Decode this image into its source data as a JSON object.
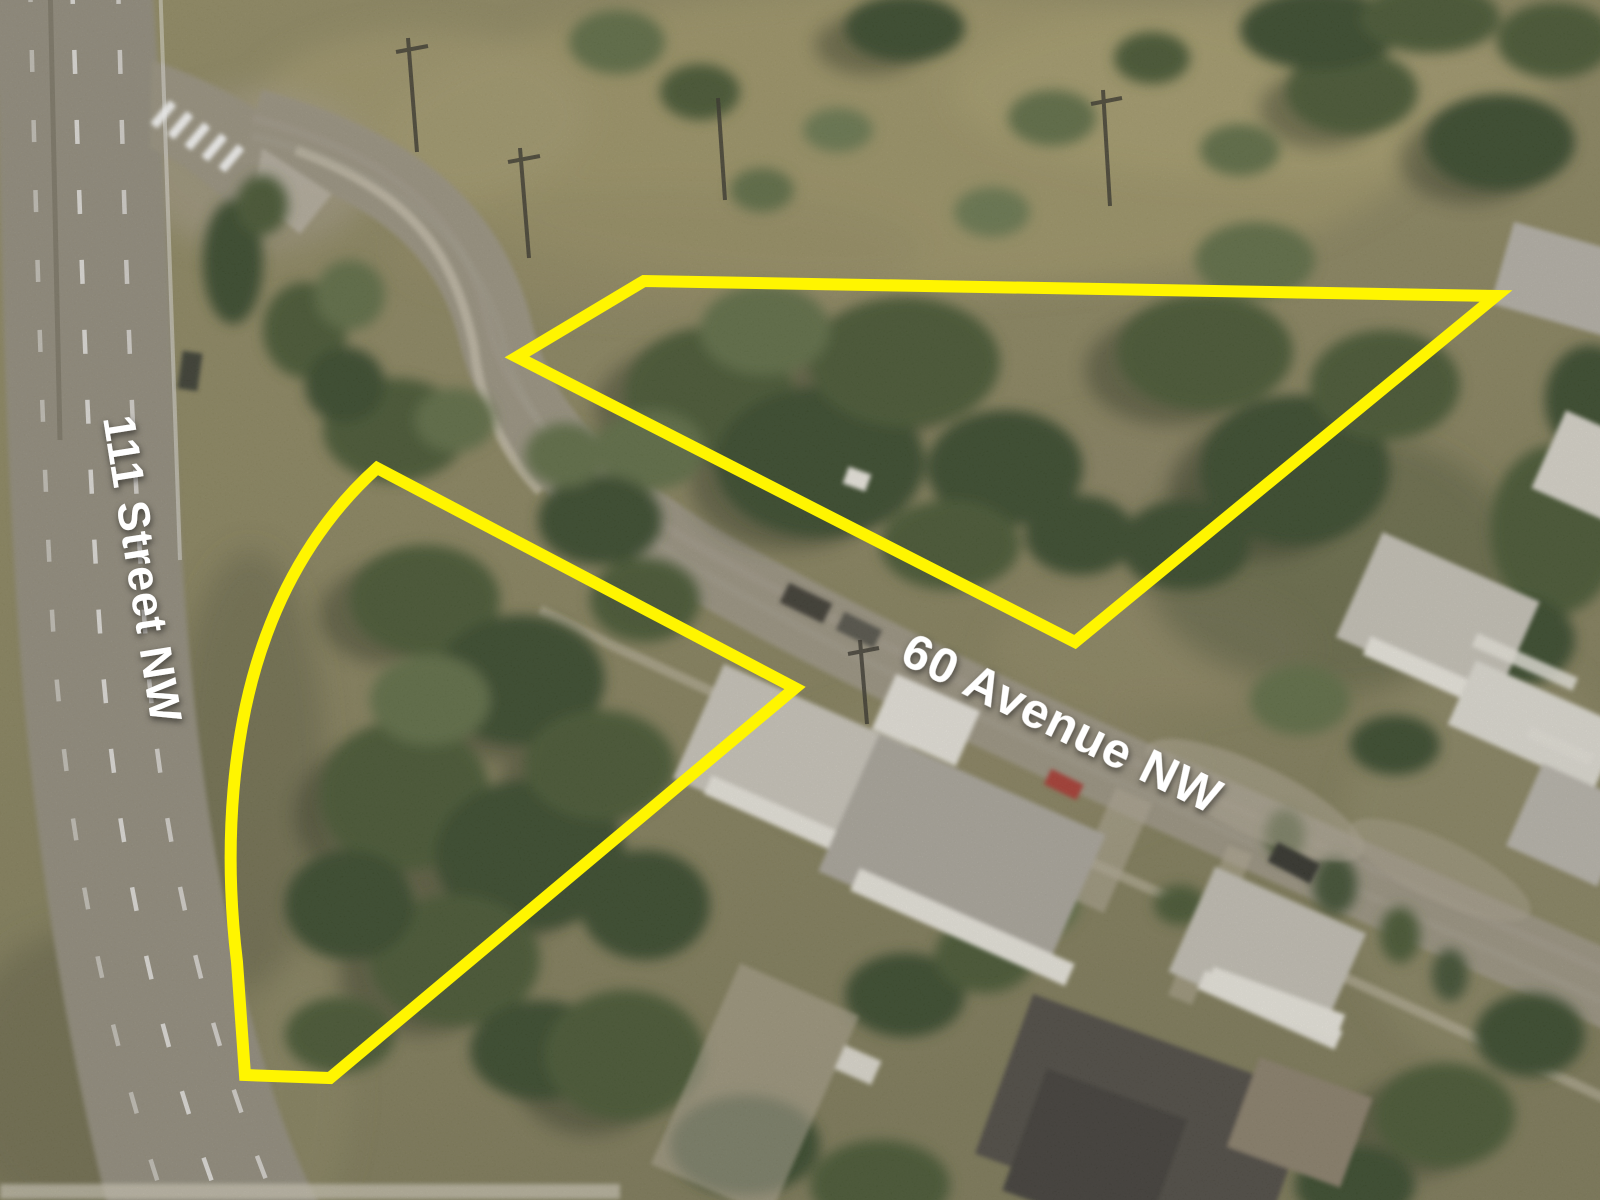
{
  "labels": {
    "street_vertical": {
      "text": "111 Street NW",
      "color": "#ffffff"
    },
    "street_diagonal": {
      "text": "60 Avenue NW",
      "color": "#ffffff"
    }
  },
  "overlays": {
    "highlight_color": "#fff500",
    "stroke_width_px": 12,
    "north_parcel": {
      "points": "517,357 644,281 1496,296 1075,642"
    },
    "south_parcel": {
      "path": "M 377,468 L 795,688 L 330,1078 L 245,1075 L 237,962 C 223,846 232,728 266,636 C 290,570 328,512 377,468 Z"
    }
  },
  "scene": {
    "palette": {
      "field": "#8e8862",
      "field_light": "#a49a6f",
      "trees_dark": "#39482c",
      "trees_mid": "#465632",
      "trees_light": "#5f6d44",
      "road": "#97907f",
      "roof_light": "#c9c5ba",
      "roof_dark": "#4e4a42",
      "marking_white": "#ffffff"
    }
  }
}
